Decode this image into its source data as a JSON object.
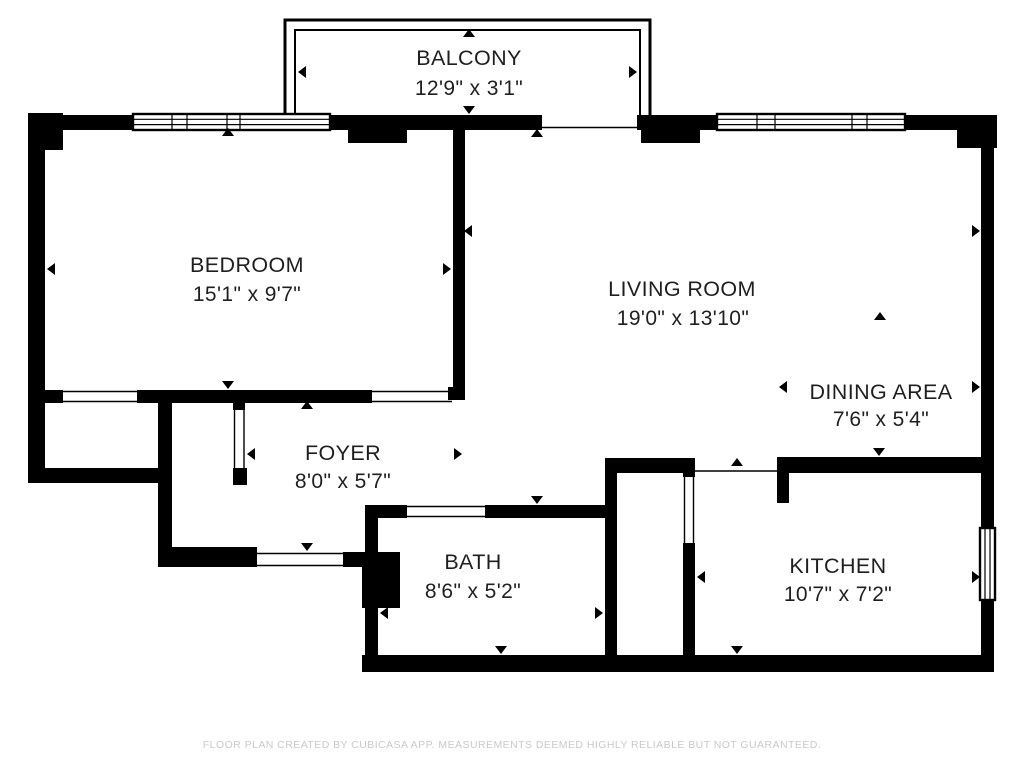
{
  "title": "Apartment floor plan",
  "rooms": {
    "balcony": {
      "name": "BALCONY",
      "dims": "12'9\" x 3'1\""
    },
    "bedroom": {
      "name": "BEDROOM",
      "dims": "15'1\" x 9'7\""
    },
    "living": {
      "name": "LIVING ROOM",
      "dims": "19'0\" x 13'10\""
    },
    "dining": {
      "name": "DINING AREA",
      "dims": "7'6\" x 5'4\""
    },
    "foyer": {
      "name": "FOYER",
      "dims": "8'0\" x 5'7\""
    },
    "bath": {
      "name": "BATH",
      "dims": "8'6\" x 5'2\""
    },
    "kitchen": {
      "name": "KITCHEN",
      "dims": "10'7\" x 7'2\""
    }
  },
  "footer": {
    "text": "FLOOR PLAN CREATED BY CUBICASA APP. MEASUREMENTS DEEMED HIGHLY RELIABLE BUT NOT GUARANTEED."
  },
  "colors": {
    "wall": "#000000",
    "background": "#ffffff",
    "label": "#1f1f1f",
    "footer": "#c9c9c9"
  }
}
